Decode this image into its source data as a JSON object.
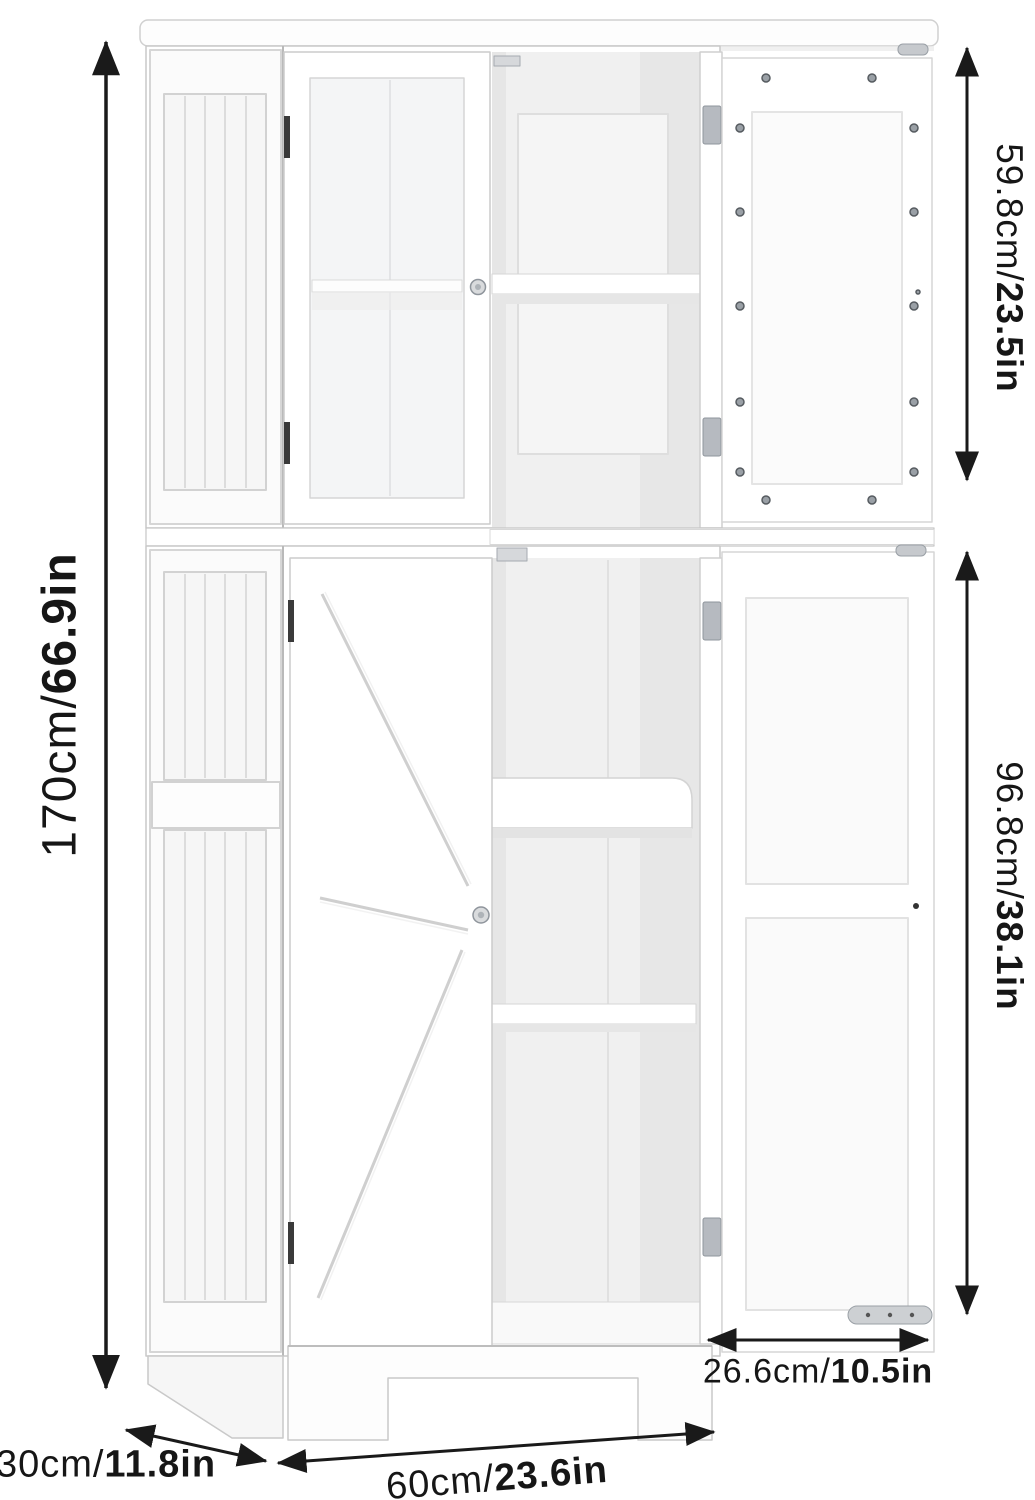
{
  "dimensions": {
    "height": {
      "cm": "170cm/",
      "in": "66.9in"
    },
    "upper_section": {
      "cm": "59.8cm/",
      "in": "23.5in"
    },
    "lower_section": {
      "cm": "96.8cm/",
      "in": "38.1in"
    },
    "door_width": {
      "cm": "26.6cm/",
      "in": "10.5in"
    },
    "depth": {
      "cm": "30cm/",
      "in": "11.8in"
    },
    "width": {
      "cm": "60cm/",
      "in": "23.6in"
    }
  },
  "colors": {
    "background": "#ffffff",
    "cabinet": "#ffffff",
    "outline": "#c9c9c9",
    "interior_shadow": "#efefef",
    "arrow": "#1a1a1a",
    "metal": "#b6bac0"
  }
}
